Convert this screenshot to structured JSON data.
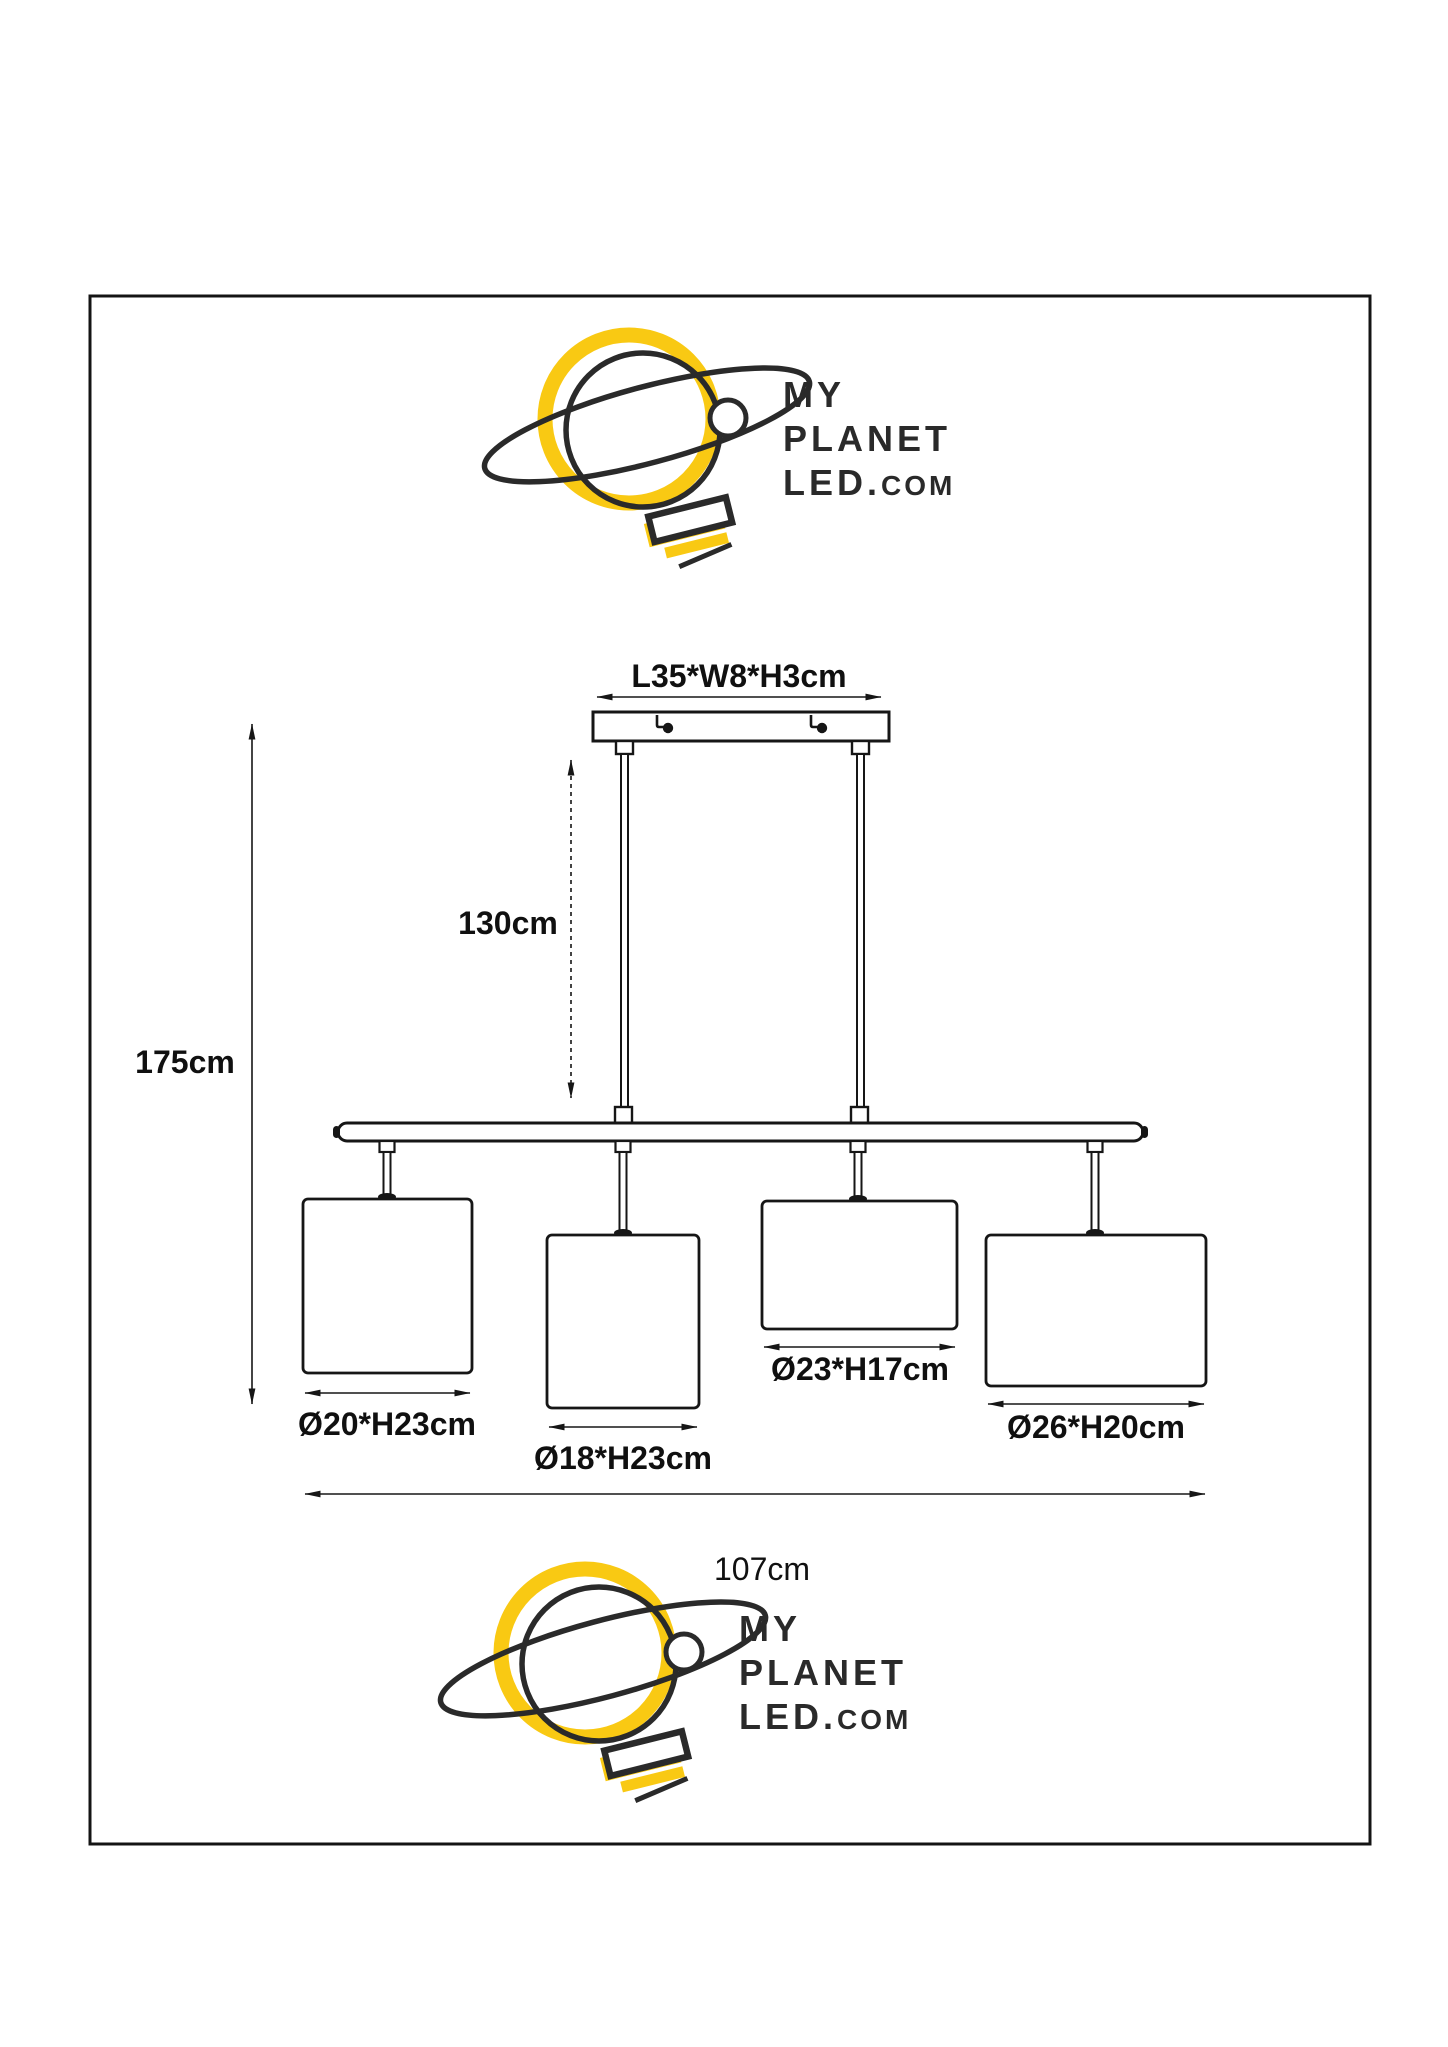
{
  "page": {
    "background": "#ffffff",
    "border_color": "#141414"
  },
  "brand": {
    "word1": "MY",
    "word2": "PLANET",
    "word3": "LED.",
    "word3_suffix": "COM",
    "colors": {
      "yellow": "#F9C913",
      "ink": "#2A2A2A"
    },
    "logo_icon": "planet-with-orbit-and-lightbulb-icon"
  },
  "dimensions": {
    "canopy": "L35*W8*H3cm",
    "suspension": "130cm",
    "total_height": "175cm",
    "total_width": "107cm",
    "shade1": "Ø20*H23cm",
    "shade2": "Ø18*H23cm",
    "shade3": "Ø23*H17cm",
    "shade4": "Ø26*H20cm"
  }
}
